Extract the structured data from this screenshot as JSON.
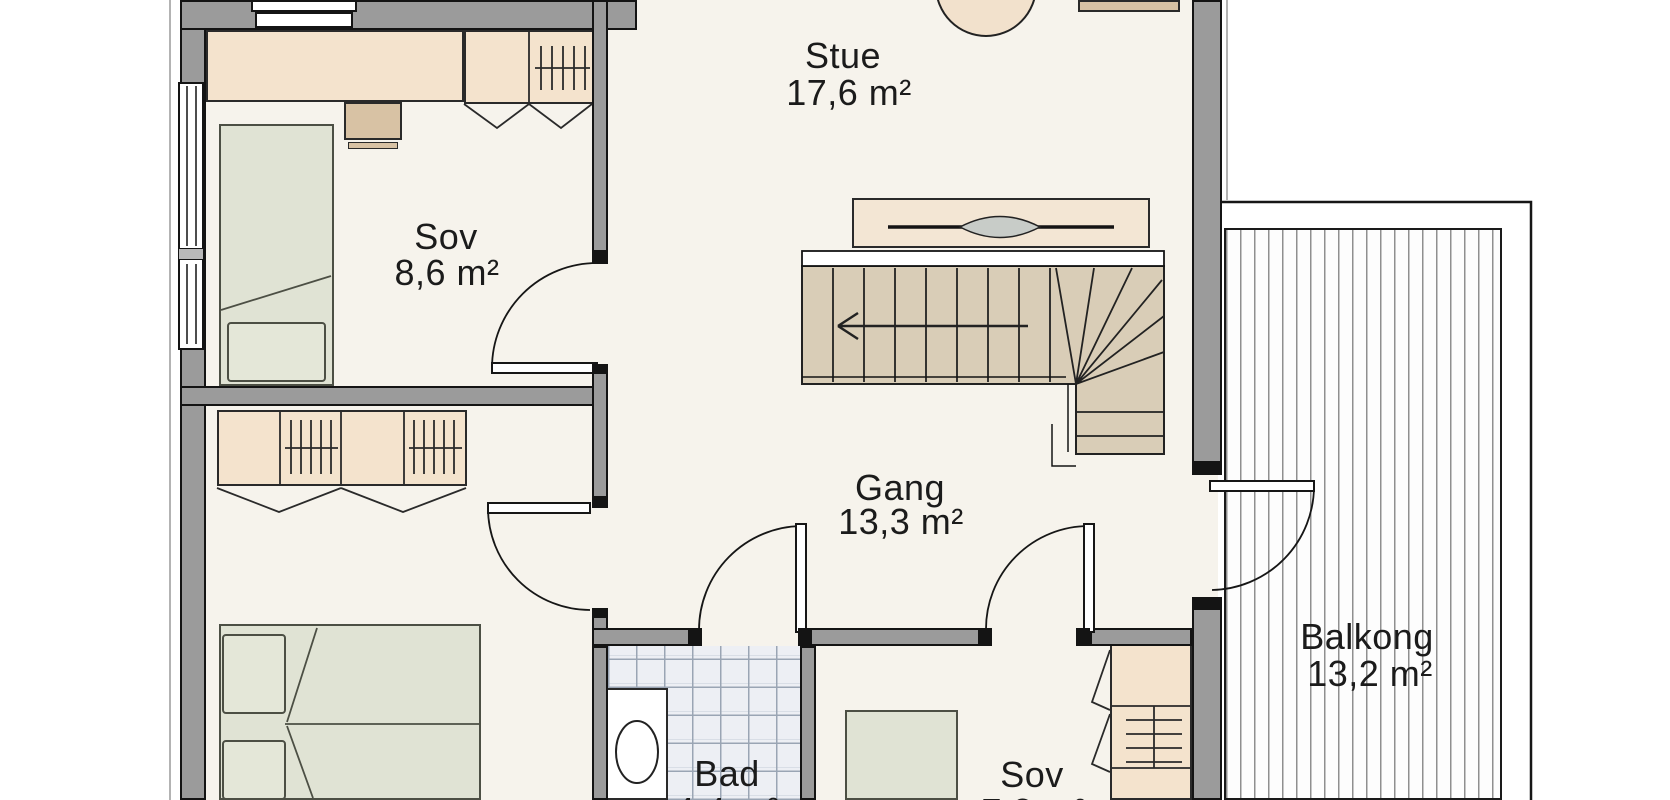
{
  "plan": {
    "title": "Floor plan, upper storey",
    "rooms": {
      "stue": {
        "name": "Stue",
        "area": "17,6 m²"
      },
      "sov1": {
        "name": "Sov",
        "area": "8,6 m²"
      },
      "gang": {
        "name": "Gang",
        "area": "13,3 m²"
      },
      "bad": {
        "name": "Bad",
        "area": "4,4 m²"
      },
      "sov2": {
        "name": "Sov",
        "area": "7,2 m²"
      },
      "balkong": {
        "name": "Balkong",
        "area": "13,2 m²"
      }
    },
    "colors": {
      "wall": "#9b9b9b",
      "floor": "#f6f3ec",
      "furniture_beige": "#f4e3cd",
      "furniture_tan": "#d8c2a4",
      "bed_green": "#e0e3d4",
      "stair_tan": "#d9cdb7",
      "tile": "#edeff4",
      "line": "#1a1a1a"
    }
  }
}
